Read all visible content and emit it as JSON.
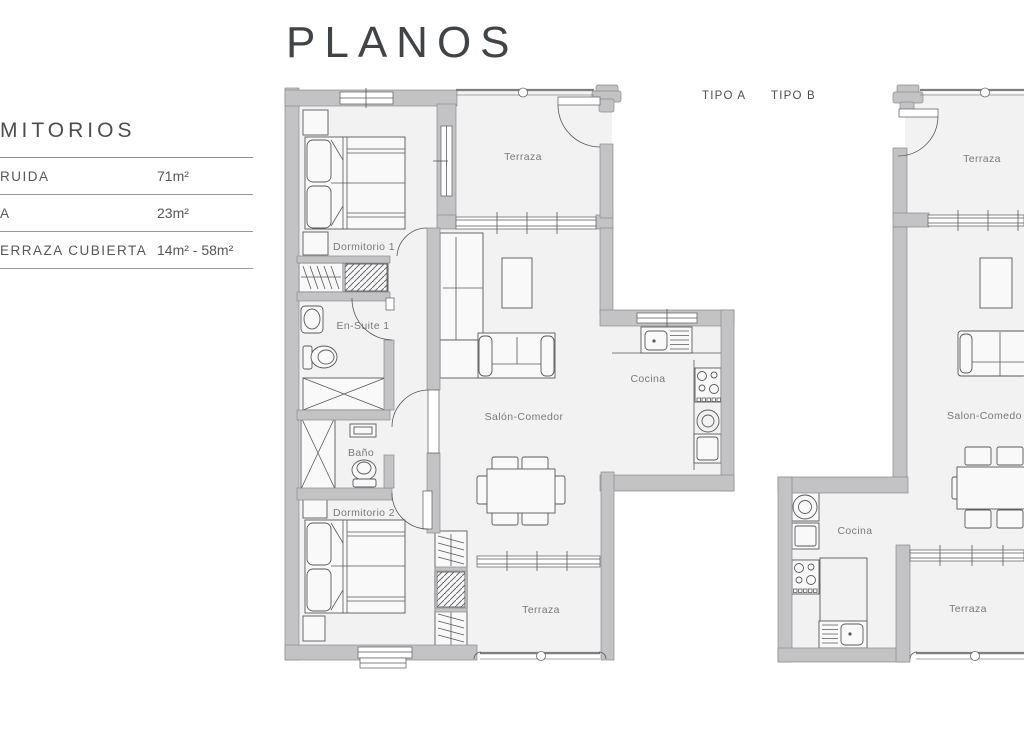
{
  "page": {
    "title": "PLANOS"
  },
  "sidebar": {
    "header": "MITORIOS",
    "rows": [
      {
        "label": "RUIDA",
        "value": "71m²"
      },
      {
        "label": "A",
        "value": "23m²"
      },
      {
        "label": "ERRAZA CUBIERTA",
        "value": "14m² - 58m²"
      }
    ]
  },
  "plans": {
    "tipo_a": {
      "label": "TIPO A",
      "rooms": {
        "terraza_top": "Terraza",
        "dormitorio1": "Dormitorio 1",
        "ensuite1": "En-Suite 1",
        "bano": "Baño",
        "salon": "Salón-Comedor",
        "cocina": "Cocina",
        "dormitorio2": "Dormitorio 2",
        "terraza_bottom": "Terraza"
      }
    },
    "tipo_b": {
      "label": "TIPO B",
      "rooms": {
        "terraza_top": "Terraza",
        "salon": "Salon-Comedo",
        "cocina": "Cocina",
        "terraza_bottom": "Terraza"
      }
    }
  },
  "colors": {
    "wall": "#c3c3c5",
    "room_fill": "#f2f2f3",
    "line": "#58595c",
    "label_text": "#797a7d",
    "title_text": "#3f4449"
  }
}
